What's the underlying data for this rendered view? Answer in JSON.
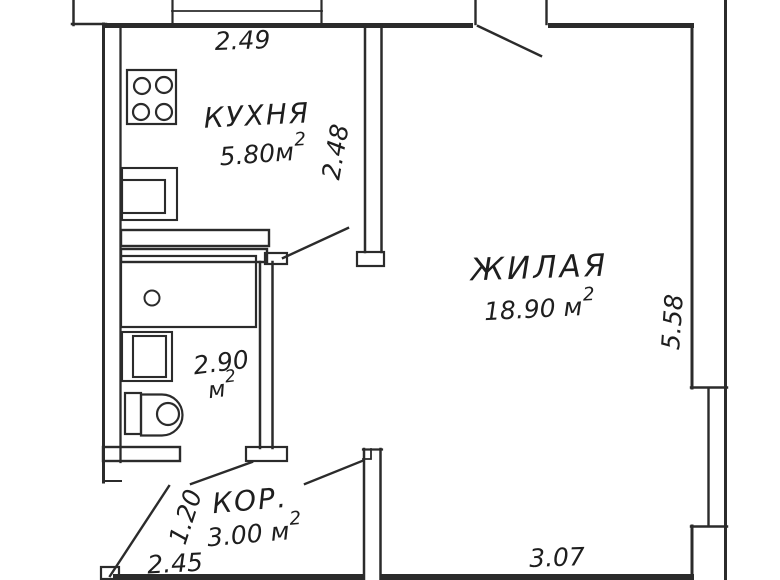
{
  "plan": {
    "type": "apartment-floor-plan",
    "rooms": {
      "kitchen": {
        "name": "КУХНЯ",
        "area_value": "5.80м",
        "area_sup": "2"
      },
      "living": {
        "name": "ЖИЛАЯ",
        "area_value": "18.90 м",
        "area_sup": "2"
      },
      "bathroom": {
        "area_value": "2.90",
        "area_unit": "м",
        "area_sup": "2"
      },
      "corridor": {
        "name": "КОР.",
        "area_value": "3.00 м",
        "area_sup": "2"
      }
    },
    "dimensions": {
      "kitchen_width": "2.49",
      "kitchen_depth": "2.48",
      "living_depth": "5.58",
      "living_width": "3.07",
      "entry_width": "1.20",
      "corridor_width": "2.45"
    },
    "colors": {
      "line": "#2b2b2b",
      "background": "#ffffff"
    }
  }
}
